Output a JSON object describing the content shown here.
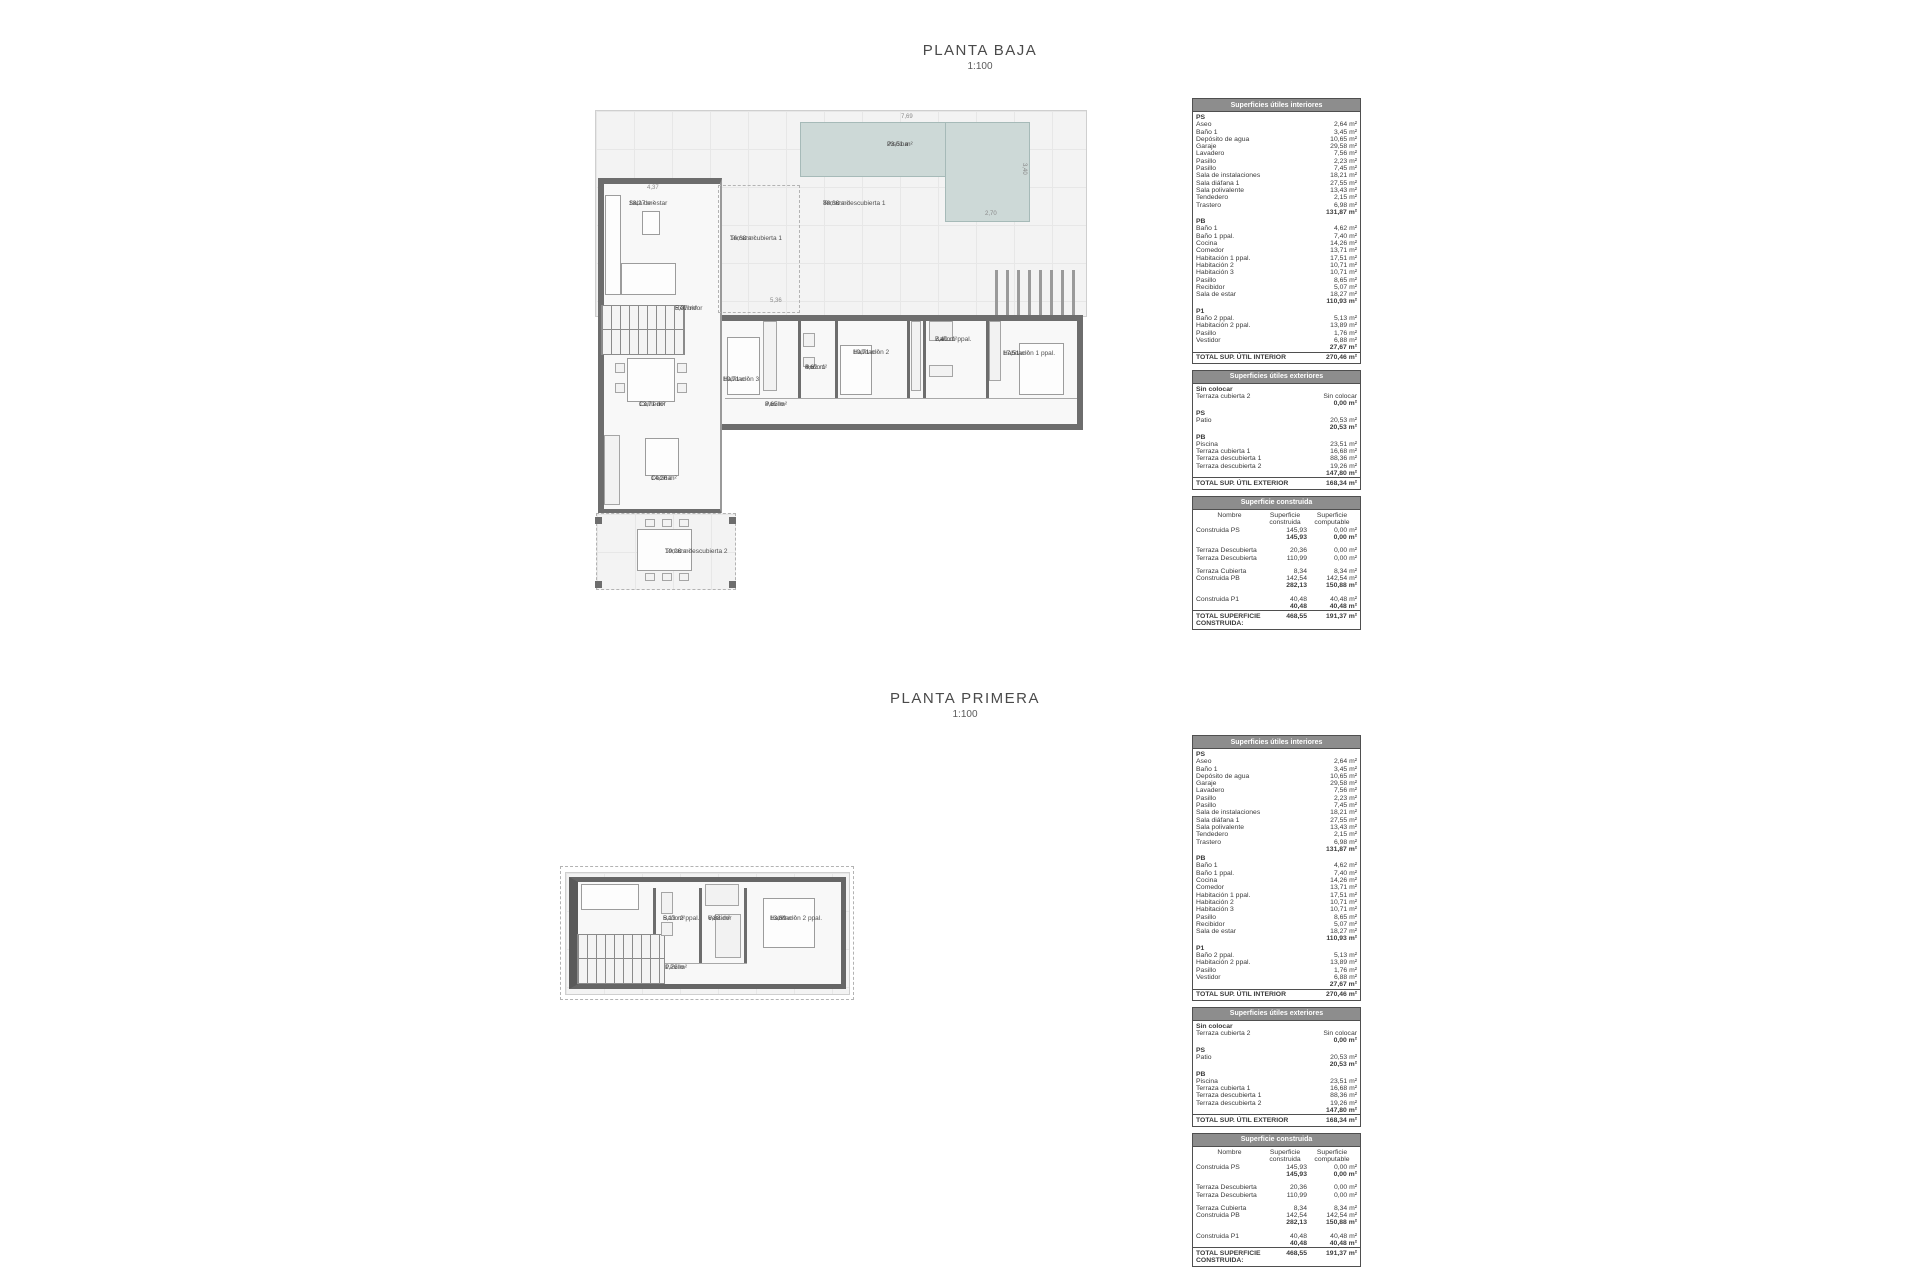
{
  "planta_baja": {
    "title": "PLANTA BAJA",
    "scale": "1:100"
  },
  "planta_primera": {
    "title": "PLANTA PRIMERA",
    "scale": "1:100"
  },
  "colors": {
    "pool": "#cdd9d7",
    "wall": "#6d6d6d",
    "table_header_bg": "#8d8d8d"
  },
  "baja_labels": [
    {
      "name": "Piscina",
      "area": "23,51 m²",
      "x": 292,
      "y": 36
    },
    {
      "name": "Terraza descubierta 1",
      "area": "88,36 m²",
      "x": 228,
      "y": 95
    },
    {
      "name": "Sala de estar",
      "area": "18,27 m²",
      "x": 34,
      "y": 95
    },
    {
      "name": "Terraza cubierta 1",
      "area": "16,68 m²",
      "x": 135,
      "y": 130,
      "w": 58
    },
    {
      "name": "Recibidor",
      "area": "5,07 m²",
      "x": 80,
      "y": 200
    },
    {
      "name": "Comedor",
      "area": "13,71 m²",
      "x": 44,
      "y": 296
    },
    {
      "name": "Cocina",
      "area": "14,26 m²",
      "x": 56,
      "y": 370
    },
    {
      "name": "Pasillo",
      "area": "8,65 m²",
      "x": 170,
      "y": 296
    },
    {
      "name": "Habitación 3",
      "area": "10,71 m²",
      "x": 128,
      "y": 271
    },
    {
      "name": "Baño 1",
      "area": "4,62 m²",
      "x": 210,
      "y": 259
    },
    {
      "name": "Habitación 2",
      "area": "10,71 m²",
      "x": 258,
      "y": 244
    },
    {
      "name": "Baño 1 ppal.",
      "area": "7,40 m²",
      "x": 340,
      "y": 231
    },
    {
      "name": "Habitación 1 ppal.",
      "area": "17,51 m²",
      "x": 408,
      "y": 245
    },
    {
      "name": "Terraza descubierta 2",
      "area": "19,26 m²",
      "x": 70,
      "y": 443
    }
  ],
  "baja_dims": [
    {
      "text": "7,69",
      "x": 306,
      "y": 9
    },
    {
      "text": "3,40",
      "x": 432,
      "y": 58,
      "rot": true
    },
    {
      "text": "2,70",
      "x": 390,
      "y": 106
    },
    {
      "text": "4,37",
      "x": 52,
      "y": 80
    },
    {
      "text": "5,36",
      "x": 175,
      "y": 193
    }
  ],
  "primera_labels": [
    {
      "name": "Baño 2 ppal.",
      "area": "5,13 m²",
      "x": 98,
      "y": 43
    },
    {
      "name": "Vestidor",
      "area": "6,88 m²",
      "x": 143,
      "y": 43
    },
    {
      "name": "Habitación 2 ppal.",
      "area": "13,89 m²",
      "x": 205,
      "y": 43
    },
    {
      "name": "Pasillo",
      "area": "1,76 m²",
      "x": 100,
      "y": 92
    }
  ],
  "tables": {
    "interiores": {
      "title": "Superficies útiles interiores",
      "groups": [
        {
          "heading": "PS",
          "rows": [
            [
              "Aseo",
              "2,64 m²"
            ],
            [
              "Baño 1",
              "3,45 m²"
            ],
            [
              "Depósito de agua",
              "10,65 m²"
            ],
            [
              "Garaje",
              "29,58 m²"
            ],
            [
              "Lavadero",
              "7,56 m²"
            ],
            [
              "Pasillo",
              "2,23 m²"
            ],
            [
              "Pasillo",
              "7,45 m²"
            ],
            [
              "Sala de instalaciones",
              "18,21 m²"
            ],
            [
              "Sala diáfana 1",
              "27,55 m²"
            ],
            [
              "Sala polivalente",
              "13,43 m²"
            ],
            [
              "Tendedero",
              "2,15 m²"
            ],
            [
              "Trastero",
              "6,98 m²"
            ]
          ],
          "subtotal": "131,87 m²"
        },
        {
          "heading": "PB",
          "rows": [
            [
              "Baño 1",
              "4,62 m²"
            ],
            [
              "Baño 1 ppal.",
              "7,40 m²"
            ],
            [
              "Cocina",
              "14,26 m²"
            ],
            [
              "Comedor",
              "13,71 m²"
            ],
            [
              "Habitación 1 ppal.",
              "17,51 m²"
            ],
            [
              "Habitación 2",
              "10,71 m²"
            ],
            [
              "Habitación 3",
              "10,71 m²"
            ],
            [
              "Pasillo",
              "8,65 m²"
            ],
            [
              "Recibidor",
              "5,07 m²"
            ],
            [
              "Sala de estar",
              "18,27 m²"
            ]
          ],
          "subtotal": "110,93 m²"
        },
        {
          "heading": "P1",
          "rows": [
            [
              "Baño 2 ppal.",
              "5,13 m²"
            ],
            [
              "Habitación 2 ppal.",
              "13,89 m²"
            ],
            [
              "Pasillo",
              "1,76 m²"
            ],
            [
              "Vestidor",
              "6,88 m²"
            ]
          ],
          "subtotal": "27,67 m²"
        }
      ],
      "total_label": "TOTAL SUP.  ÚTIL INTERIOR",
      "total_value": "270,46 m²"
    },
    "exteriores": {
      "title": "Superficies útiles exteriores",
      "groups": [
        {
          "heading": "Sin colocar",
          "rows": [
            [
              "Terraza cubierta 2",
              "Sin colocar"
            ]
          ],
          "subtotal": "0,00 m²"
        },
        {
          "heading": "PS",
          "rows": [
            [
              "Patio",
              "20,53 m²"
            ]
          ],
          "subtotal": "20,53 m²"
        },
        {
          "heading": "PB",
          "rows": [
            [
              "Piscina",
              "23,51 m²"
            ],
            [
              "Terraza cubierta 1",
              "16,68 m²"
            ],
            [
              "Terraza descubierta 1",
              "88,36 m²"
            ],
            [
              "Terraza descubierta 2",
              "19,26 m²"
            ]
          ],
          "subtotal": "147,80 m²"
        }
      ],
      "total_label": "TOTAL SUP.  ÚTIL EXTERIOR",
      "total_value": "168,34 m²"
    },
    "construida": {
      "title": "Superficie construida",
      "col_headers": [
        "Nombre",
        "Superficie construida",
        "Superficie computable"
      ],
      "rows": [
        {
          "name": "Construida PS",
          "built": "145,93",
          "comp": "0,00 m²",
          "style": "normal"
        },
        {
          "name": "",
          "built": "145,93",
          "comp": "0,00 m²",
          "style": "bold"
        },
        {
          "style": "spacer"
        },
        {
          "name": "Terraza Descubierta",
          "built": "20,36",
          "comp": "0,00 m²",
          "style": "normal"
        },
        {
          "name": "Terraza Descubierta",
          "built": "110,99",
          "comp": "0,00 m²",
          "style": "normal"
        },
        {
          "style": "spacer"
        },
        {
          "name": "Terraza Cubierta",
          "built": "8,34",
          "comp": "8,34 m²",
          "style": "normal"
        },
        {
          "name": "Construida PB",
          "built": "142,54",
          "comp": "142,54 m²",
          "style": "normal"
        },
        {
          "name": "",
          "built": "282,13",
          "comp": "150,88 m²",
          "style": "bold"
        },
        {
          "style": "spacer"
        },
        {
          "name": "Construida P1",
          "built": "40,48",
          "comp": "40,48 m²",
          "style": "normal"
        },
        {
          "name": "",
          "built": "40,48",
          "comp": "40,48 m²",
          "style": "bold"
        }
      ],
      "total_label": "TOTAL SUPERFICIE CONSTRUIDA:",
      "total_built": "468,55",
      "total_comp": "191,37 m²"
    }
  }
}
